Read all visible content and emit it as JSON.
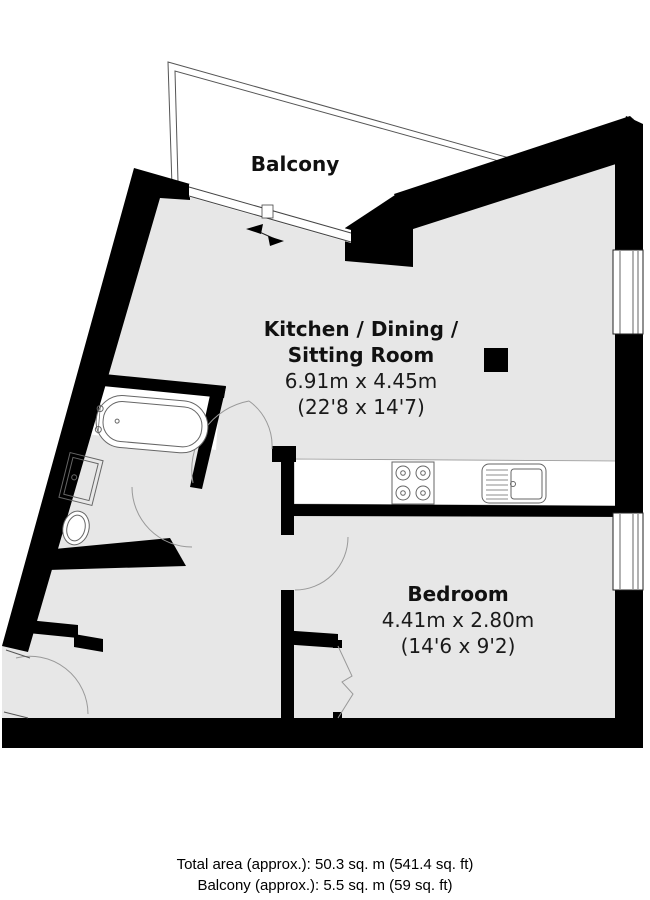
{
  "plan": {
    "balcony": {
      "label": "Balcony"
    },
    "kitchen": {
      "name_line1": "Kitchen / Dining /",
      "name_line2": "Sitting Room",
      "size_metric": "6.91m x 4.45m",
      "size_imperial": "(22'8 x 14'7)"
    },
    "bedroom": {
      "name": "Bedroom",
      "size_metric": "4.41m x 2.80m",
      "size_imperial": "(14'6 x 9'2)"
    },
    "footer": {
      "total_area": "Total area (approx.): 50.3 sq. m (541.4 sq. ft)",
      "balcony_area": "Balcony (approx.): 5.5 sq. m (59 sq. ft)"
    },
    "colors": {
      "wall": "#000000",
      "floor": "#e7e7e7",
      "fixture_outline": "#666666",
      "text": "#111111",
      "background": "#ffffff"
    },
    "fixtures": [
      "bathtub",
      "washbasin",
      "toilet",
      "hob-4-burner",
      "kitchen-sink",
      "structural-column",
      "window",
      "door-arc",
      "sliding-balcony-door",
      "closet-bifold-door"
    ]
  }
}
